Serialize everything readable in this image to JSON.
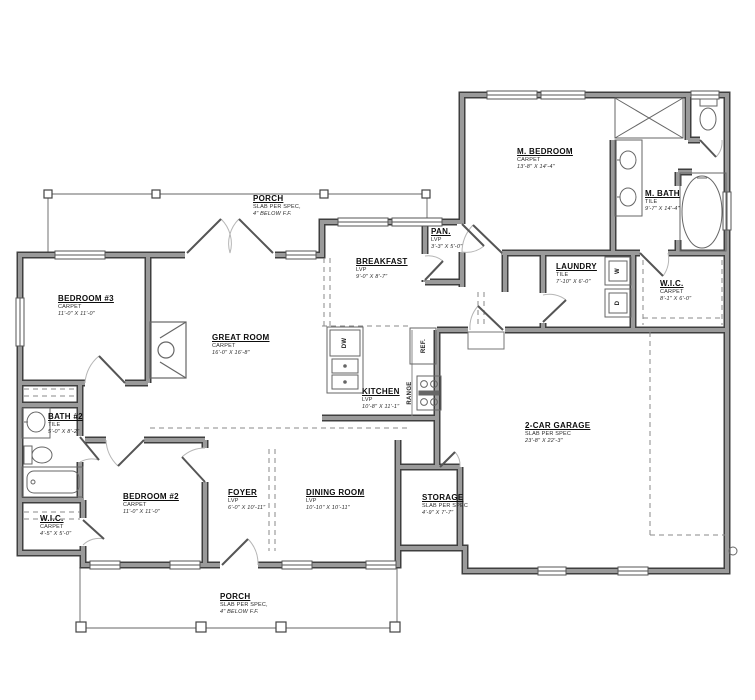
{
  "plan": {
    "rooms": [
      {
        "name": "M. BEDROOM",
        "floor": "CARPET",
        "dims": "13'-8\" X 14'-4\""
      },
      {
        "name": "M. BATH",
        "floor": "TILE",
        "dims": "9'-7\" X 14'-4\""
      },
      {
        "name": "LAUNDRY",
        "floor": "TILE",
        "dims": "7'-10\" X 6'-0\""
      },
      {
        "name": "W.I.C.",
        "floor": "CARPET",
        "dims": "8'-1\" X 6'-0\""
      },
      {
        "name": "PAN.",
        "floor": "LVP",
        "dims": "3'-3\" X 5'-0\""
      },
      {
        "name": "BREAKFAST",
        "floor": "LVP",
        "dims": "9'-0\" X 8'-7\""
      },
      {
        "name": "BEDROOM #3",
        "floor": "CARPET",
        "dims": "11'-0\" X 11'-0\""
      },
      {
        "name": "GREAT ROOM",
        "floor": "CARPET",
        "dims": "16'-0\" X 16'-8\""
      },
      {
        "name": "KITCHEN",
        "floor": "LVP",
        "dims": "10'-8\" X 11'-1\""
      },
      {
        "name": "2-CAR GARAGE",
        "floor": "SLAB PER SPEC",
        "dims": "23'-8\" X 22'-3\""
      },
      {
        "name": "BATH #2",
        "floor": "TILE",
        "dims": "5'-0\" X 8'-2\""
      },
      {
        "name": "BEDROOM #2",
        "floor": "CARPET",
        "dims": "11'-0\" X 11'-0\""
      },
      {
        "name": "W.I.C.",
        "floor": "CARPET",
        "dims": "4'-5\" X 5'-0\""
      },
      {
        "name": "FOYER",
        "floor": "LVP",
        "dims": "6'-0\" X 10'-11\""
      },
      {
        "name": "DINING ROOM",
        "floor": "LVP",
        "dims": "10'-10\" X 10'-11\""
      },
      {
        "name": "STORAGE",
        "floor": "SLAB PER SPEC",
        "dims": "4'-9\" X 7'-7\""
      },
      {
        "name": "PORCH",
        "floor": "SLAB PER SPEC,",
        "dims": "4\" BELOW F.F."
      },
      {
        "name": "PORCH",
        "floor": "SLAB PER SPEC,",
        "dims": "4\" BELOW F.F."
      }
    ],
    "appliances": [
      {
        "label": "DW"
      },
      {
        "label": "REF."
      },
      {
        "label": "RANGE"
      },
      {
        "label": "W"
      },
      {
        "label": "D"
      }
    ],
    "colors": {
      "wall_fill": "#9a9a9a",
      "wall_edge": "#3f3f3f",
      "line": "#555555",
      "dash": "#8a8a8a",
      "text": "#111111"
    }
  }
}
